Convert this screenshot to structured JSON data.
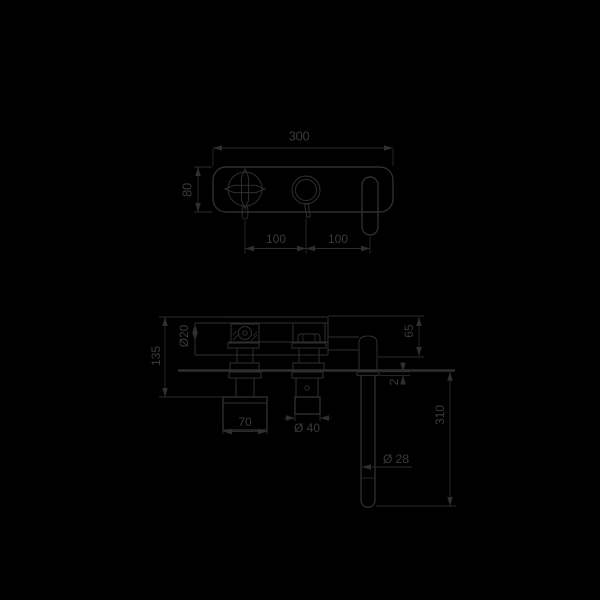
{
  "colors": {
    "background": "#000000",
    "line": "#2f2f2f",
    "text": "#3a3a3a"
  },
  "front_view": {
    "dim_width": "300",
    "dim_height": "80",
    "dim_handle_to_cartridge": "100",
    "dim_cartridge_to_spout": "100"
  },
  "side_view": {
    "dim_body_depth": "135",
    "dim_inlet_diameter": "Ø20",
    "dim_top_to_spout_axis": "65",
    "dim_wall_plate_thickness": "2",
    "dim_handle_width": "70",
    "dim_knob_diameter": "Ø 40",
    "dim_spout_length": "310",
    "dim_spout_tube_diameter": "Ø 28"
  }
}
